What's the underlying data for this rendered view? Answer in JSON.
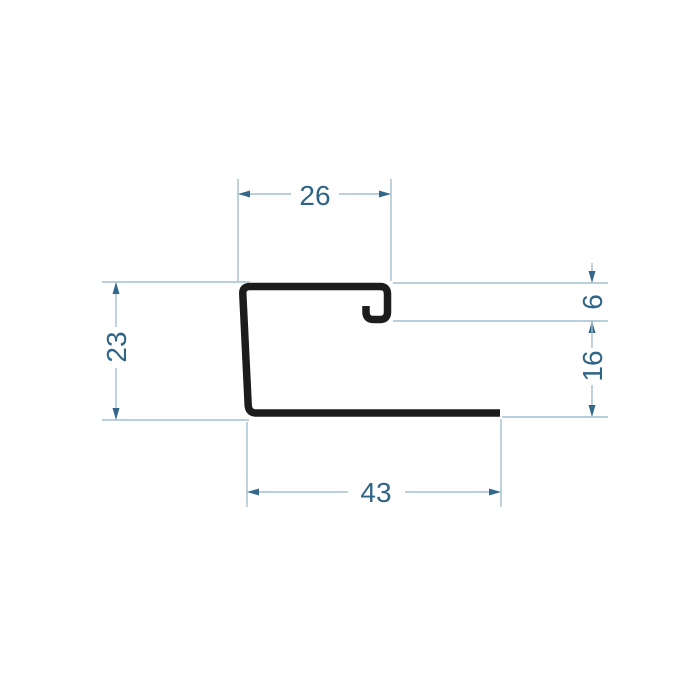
{
  "drawing": {
    "kind": "profile-cross-section-technical-drawing",
    "dimensions": {
      "top_width": "26",
      "left_height": "23",
      "bottom_width": "43",
      "right_hook_height": "6",
      "right_lower_height": "16"
    },
    "colors": {
      "profile": "#1c1c1c",
      "dim_line": "#a3bfd0",
      "dim_arrow": "#33688a",
      "dim_text": "#2e6586"
    }
  }
}
